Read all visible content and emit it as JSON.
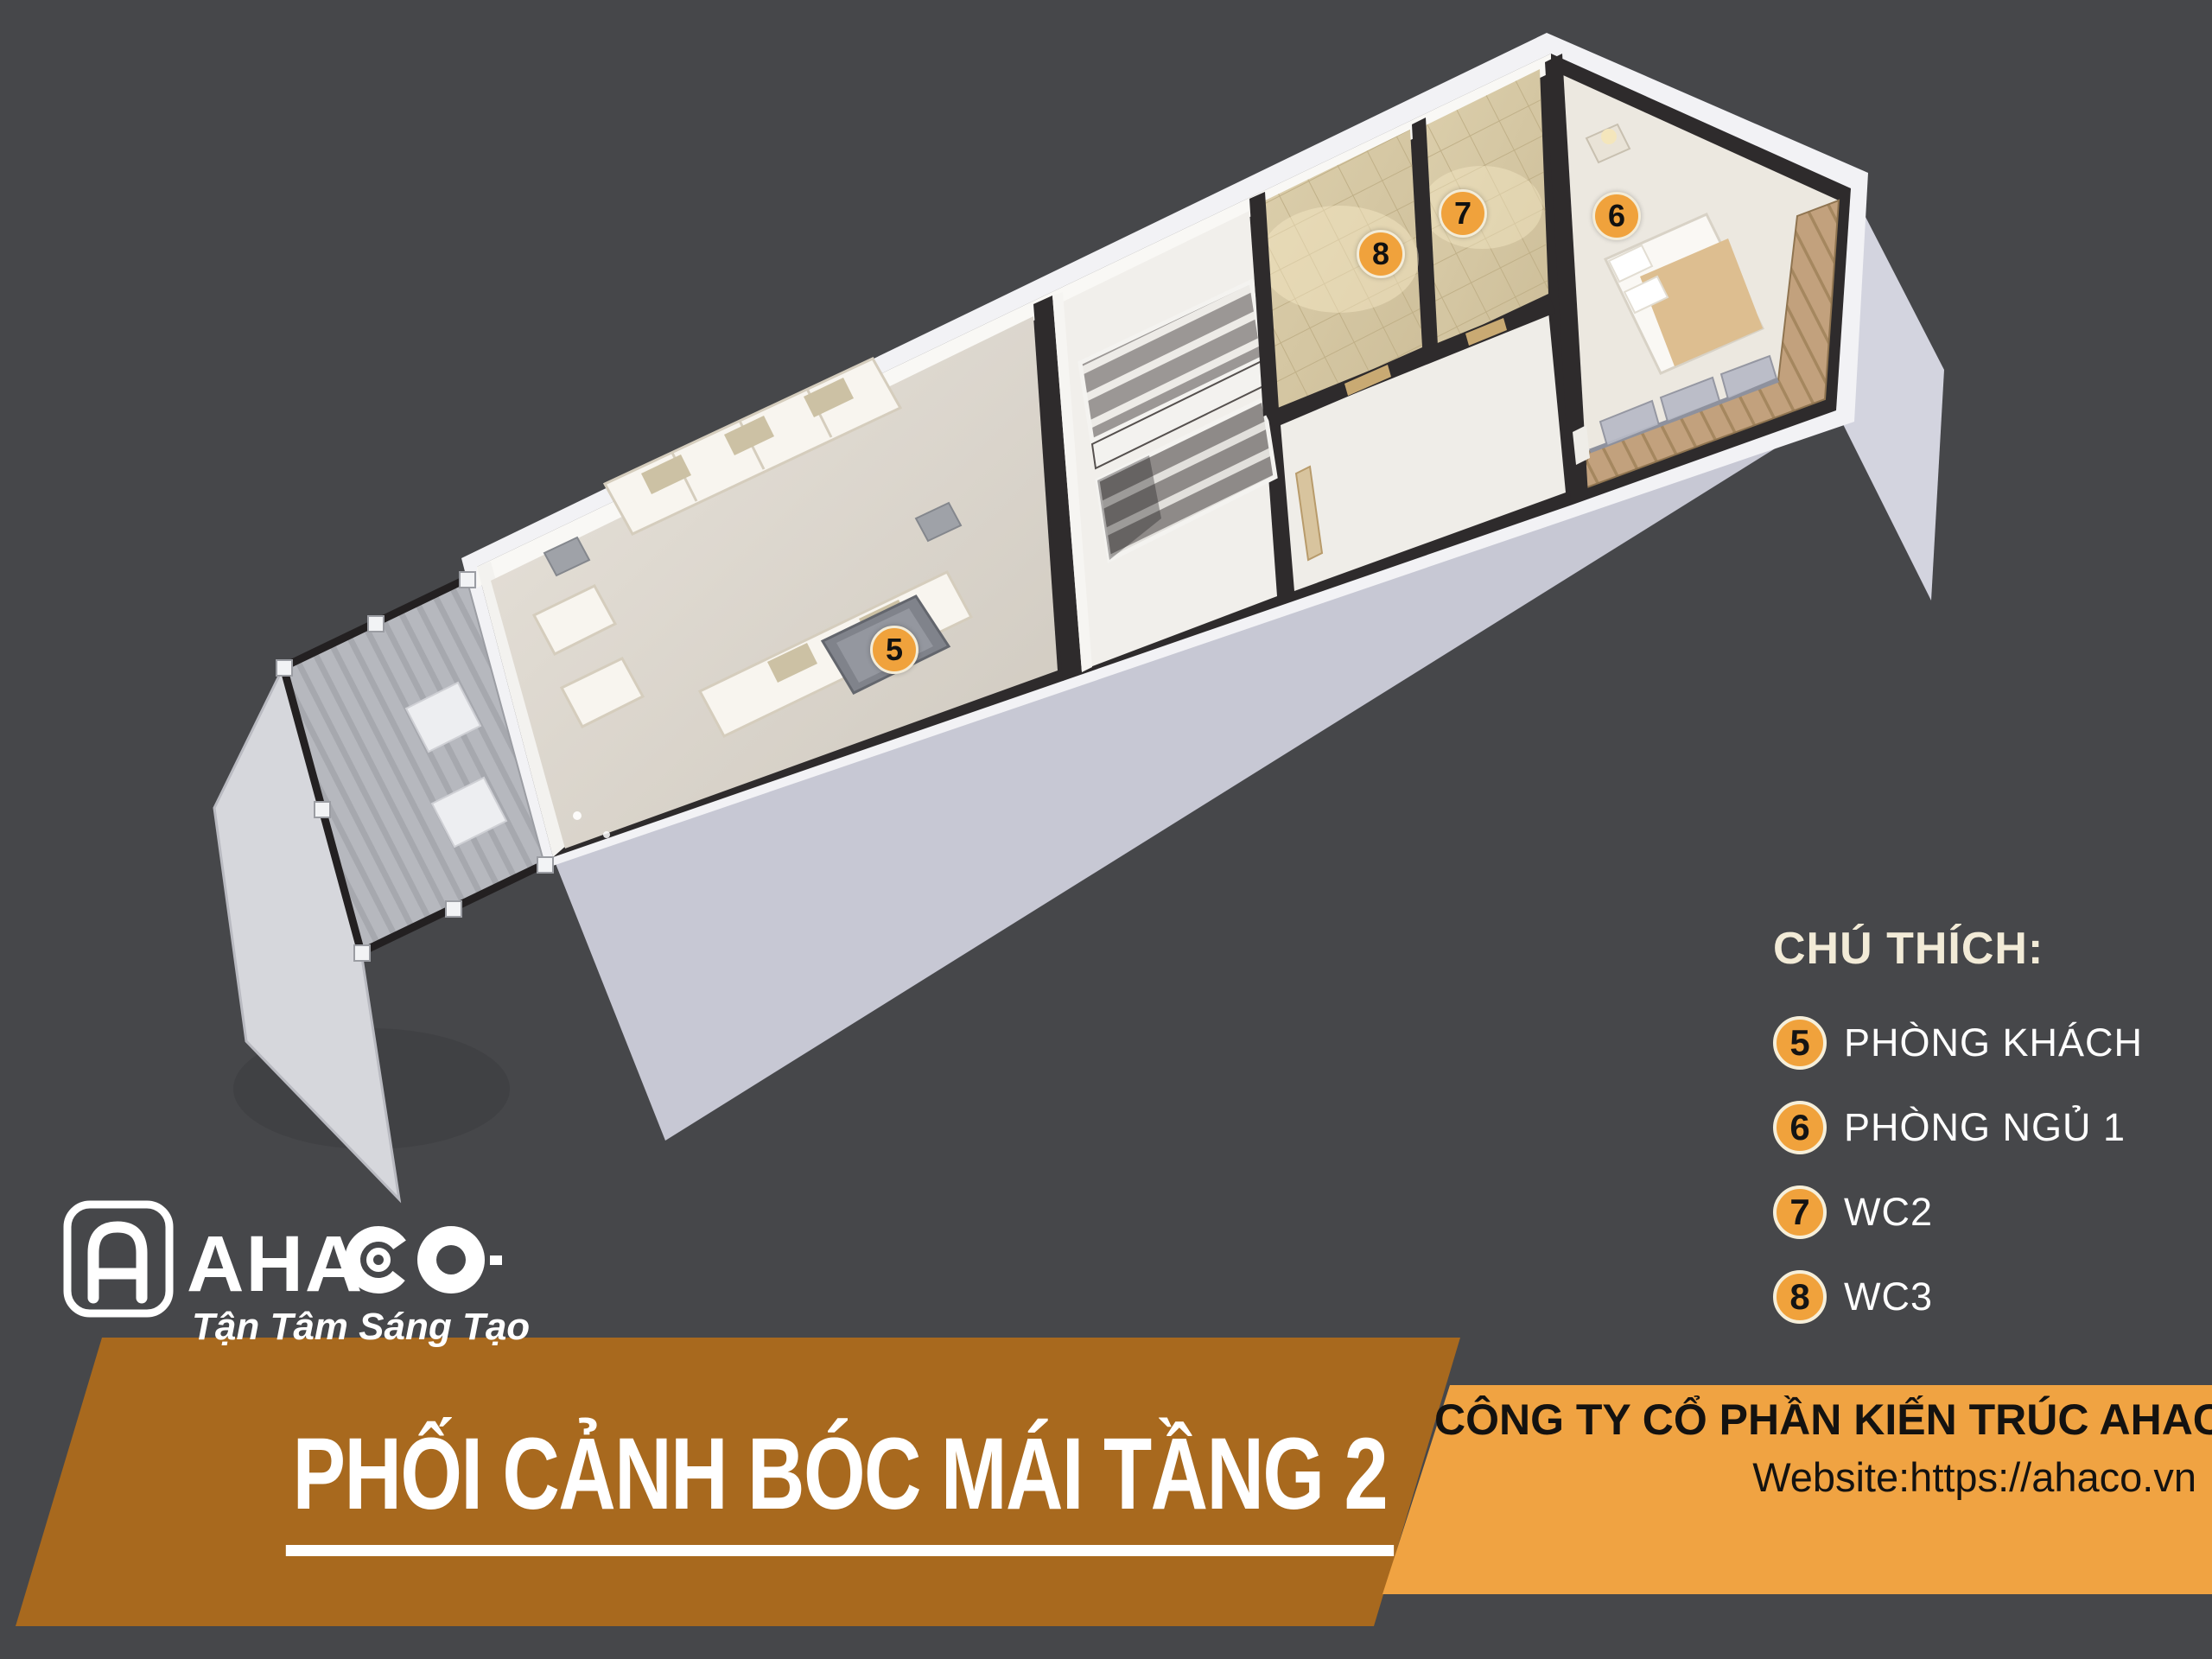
{
  "page": {
    "background": "#46474A"
  },
  "legend": {
    "title": "CHÚ THÍCH:",
    "items": [
      {
        "num": "5",
        "label": "PHÒNG KHÁCH"
      },
      {
        "num": "6",
        "label": "PHÒNG NGỦ 1"
      },
      {
        "num": "7",
        "label": "WC2"
      },
      {
        "num": "8",
        "label": "WC3"
      }
    ]
  },
  "plan": {
    "markers": [
      {
        "num": "5"
      },
      {
        "num": "6"
      },
      {
        "num": "7"
      },
      {
        "num": "8"
      }
    ]
  },
  "logo": {
    "name": "AHACO",
    "wordmark_prefix": "AHA",
    "tagline": "Tận Tâm Sáng Tạo"
  },
  "banner": {
    "title": "PHỐI CẢNH BÓC MÁI TẦNG 2"
  },
  "company": {
    "name": "CÔNG TY CỔ PHẦN KIẾN TRÚC AHACO",
    "website": "Website:https://ahaco.vn"
  },
  "colors": {
    "accent_orange": "#F0A23C",
    "banner_left": "#A8691E",
    "banner_right": "#F0A342",
    "legend_heading": "#F2EBD7",
    "wall_dark": "#2E2B2C",
    "side_wall": "#C7C8D4"
  }
}
